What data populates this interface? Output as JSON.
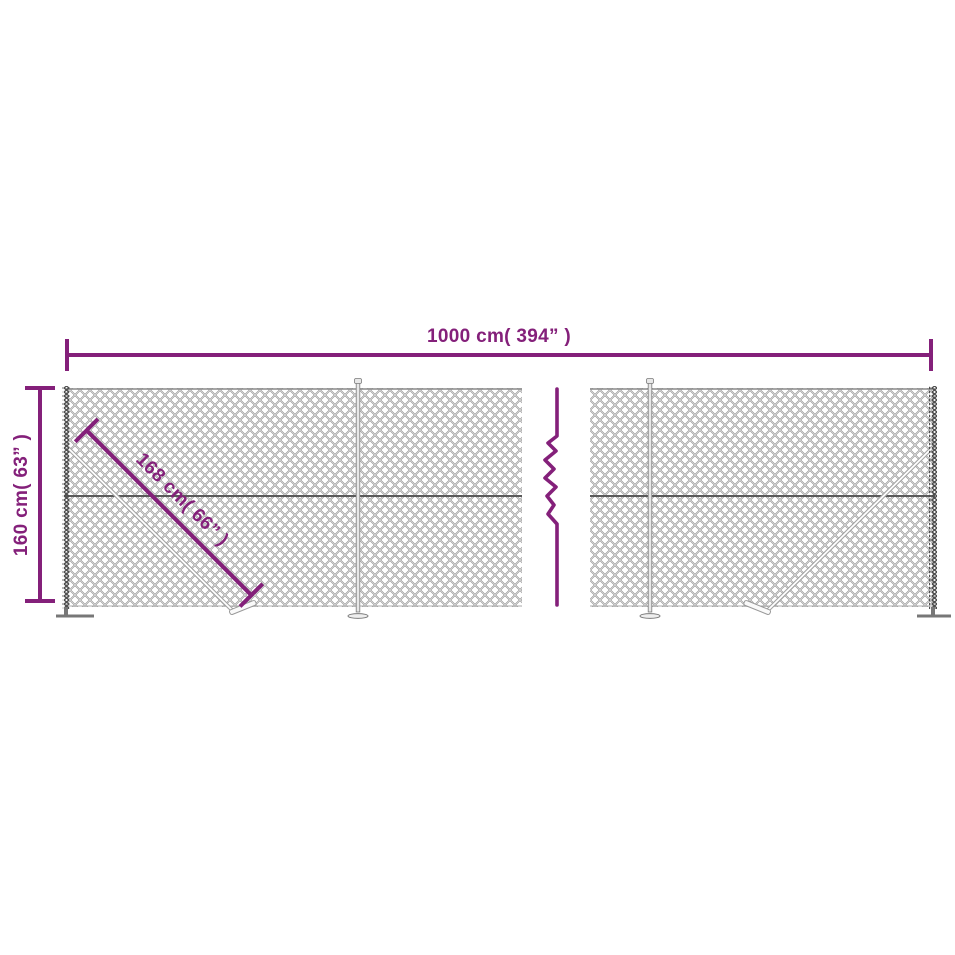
{
  "diagram": {
    "type": "product-dimension-diagram",
    "subject": "chain-link fence with flange posts"
  },
  "dimensions": {
    "width_label": "1000 cm( 394” )",
    "height_label": "160 cm( 63” )",
    "diagonal_label": "168 cm( 66” )"
  },
  "colors": {
    "accent": "#84207A",
    "mesh": "#9C9C9C",
    "wire": "#5A5A5A",
    "edge": "#4A4A4A",
    "post": "#8A8A8A"
  }
}
